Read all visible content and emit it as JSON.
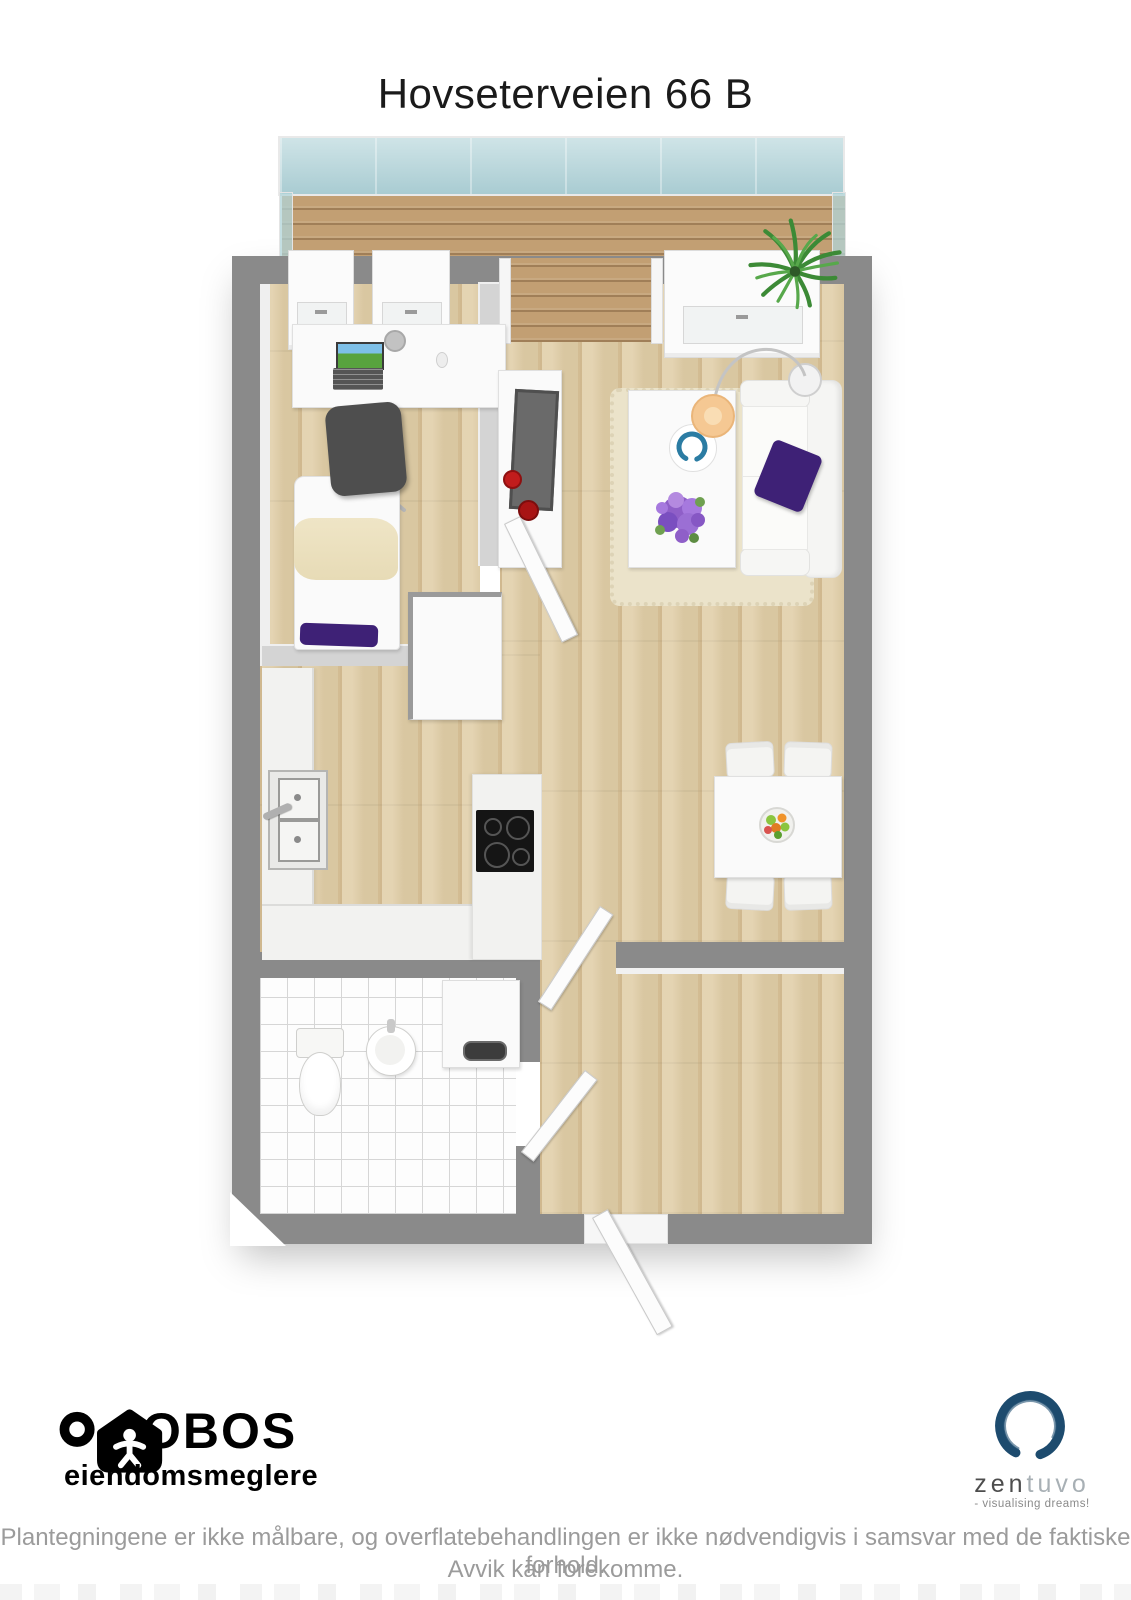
{
  "page": {
    "title": "Hovseterveien 66 B",
    "background": "#ffffff"
  },
  "floorplan": {
    "label": "3D floor plan render",
    "rooms": [
      "balcony",
      "bedroom",
      "living-room",
      "kitchen",
      "bathroom",
      "hallway"
    ],
    "icons": [
      "glass-railing-icon",
      "wood-deck-icon",
      "potted-plant-icon",
      "desk-icon",
      "laptop-icon",
      "desk-lamp-icon",
      "office-chair-icon",
      "single-bed-icon",
      "wardrobe-icon",
      "tv-console-icon",
      "tv-icon",
      "vase-icon",
      "sofa-icon",
      "sofa-cushion-icon",
      "coffee-table-icon",
      "decor-bowl-icon",
      "flower-bouquet-icon",
      "arc-lamp-icon",
      "rug-icon",
      "dining-table-icon",
      "dining-chair-icon",
      "fruit-bowl-icon",
      "kitchen-sink-icon",
      "cooktop-icon",
      "toilet-icon",
      "bathroom-sink-icon",
      "washing-machine-icon",
      "door-leaf-icon",
      "window-icon"
    ],
    "colors": {
      "outer_wall": "#8a8a8a",
      "inner_wall": "#d4d4d4",
      "wood_floor": "#e0cda6",
      "deck_wood": "#c29f73",
      "balcony_glass": "#b7d8dc",
      "bathroom_tile": "#fdfdfd",
      "accent_purple": "#3e2176",
      "flower_purple": "#9b6fd4",
      "lamp_shade": "#f5c893",
      "vase_red": "#c11c1c",
      "plant_green": "#3f8a39",
      "cooktop_black": "#151515"
    }
  },
  "footer": {
    "obos": {
      "brand": "OBOS",
      "subtitle": "eiendomsmeglere"
    },
    "zentuvo": {
      "brand_zen": "zen",
      "brand_tuvo": "tuvo",
      "tagline": "- visualising dreams!",
      "logo_color": "#1d4b6e"
    },
    "disclaimer_line1": "Plantegningene er ikke målbare, og overflatebehandlingen er ikke nødvendigvis i samsvar med de faktiske forhold.",
    "disclaimer_line2": "Avvik kan forekomme."
  }
}
